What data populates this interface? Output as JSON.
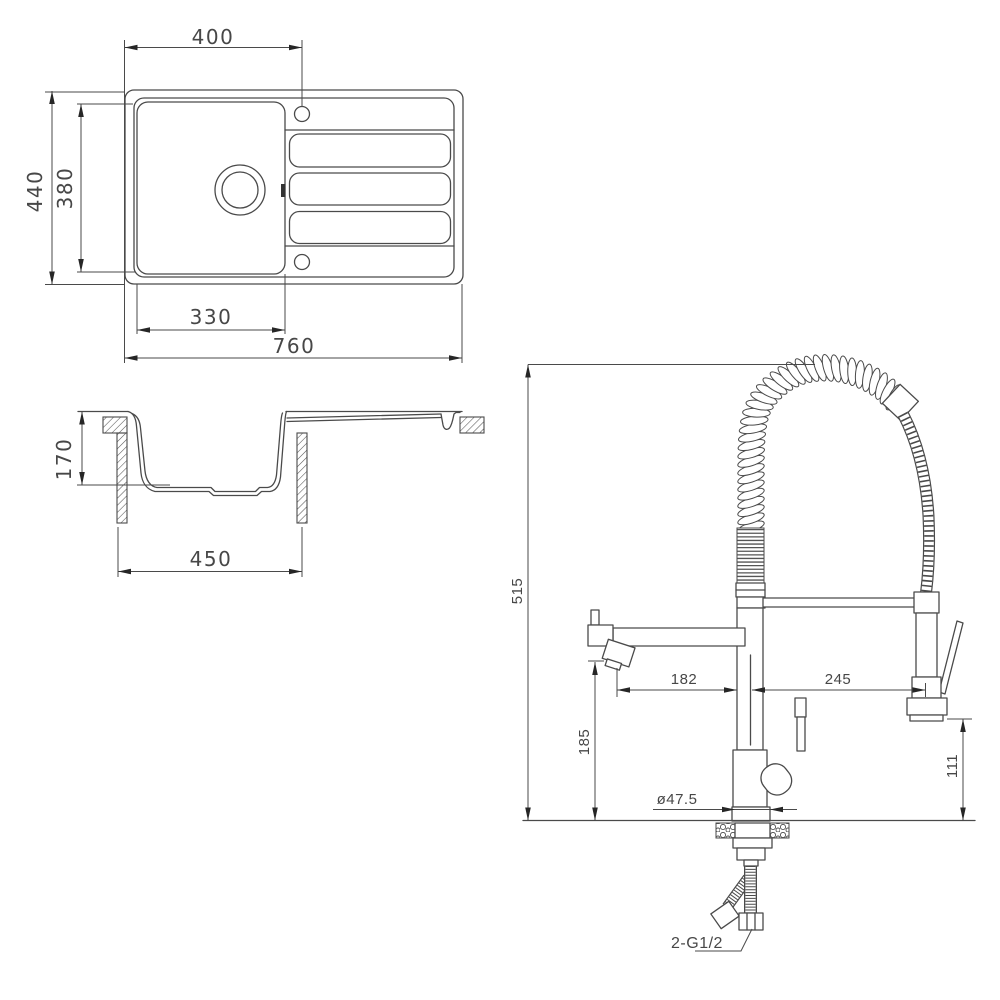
{
  "drawing": {
    "line_color": "#4a4a4a",
    "background": "#ffffff",
    "views": [
      "sink-top-view",
      "sink-section-view",
      "faucet-elevation-view"
    ]
  },
  "sink_plan": {
    "tap_offset": "400",
    "overall_depth": "440",
    "inner_depth": "380",
    "bowl_width": "330",
    "overall_width": "760"
  },
  "sink_section": {
    "bowl_depth": "170",
    "bowl_width": "450"
  },
  "faucet": {
    "overall_height": "515",
    "spout_reach": "182",
    "spray_reach": "245",
    "spout_height": "185",
    "spray_drop": "111",
    "base_diameter": "ø47.5",
    "connection": "2-G1/2"
  }
}
